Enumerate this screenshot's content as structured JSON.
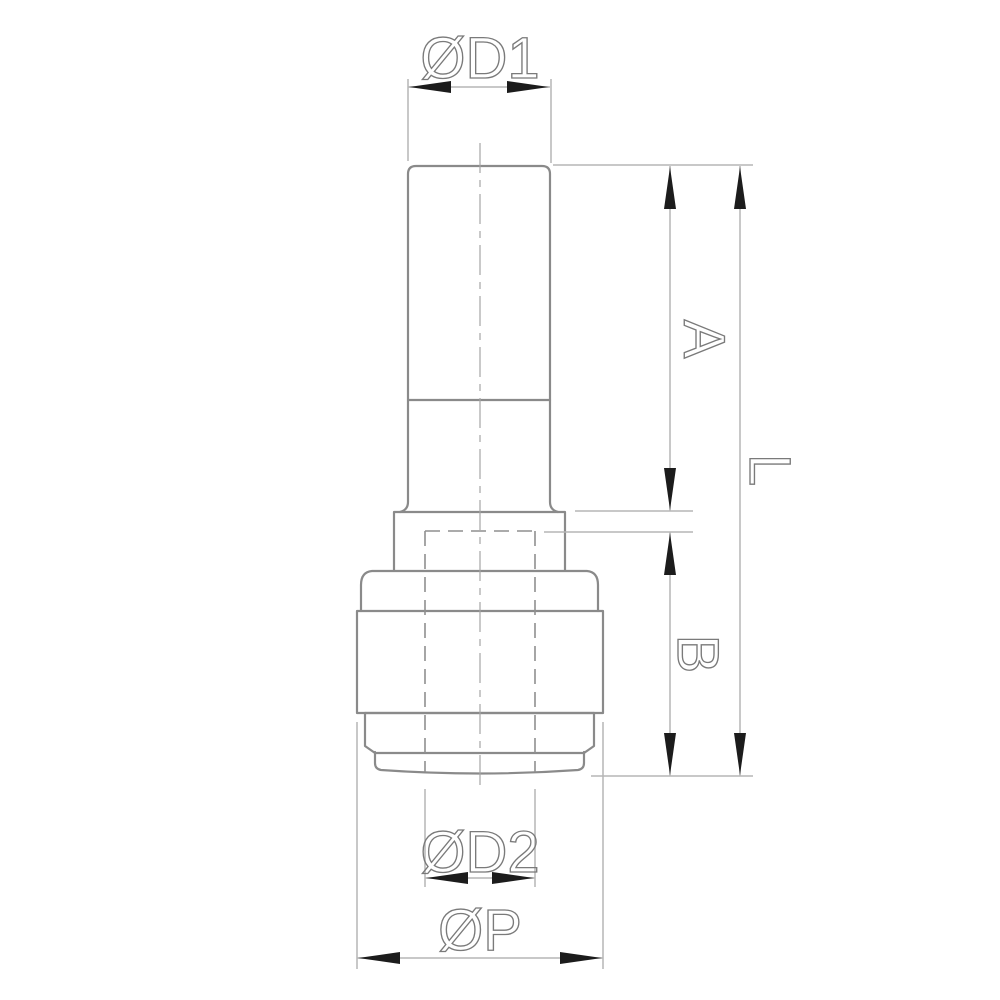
{
  "drawing": {
    "description": "dimensioned outline drawing of a push-in reducer fitting, front view",
    "labels": {
      "d1": "ØD1",
      "a": "A",
      "l": "L",
      "b": "B",
      "d2": "ØD2",
      "p": "ØP"
    },
    "colors": {
      "background": "#ffffff",
      "outline": "#8a8a8a",
      "hidden": "#8f8f8f",
      "thin": "#b5b5b5",
      "centerline": "#a5a5a5",
      "arrow": "#1c1c1c",
      "text": "#7a7a7a"
    }
  }
}
